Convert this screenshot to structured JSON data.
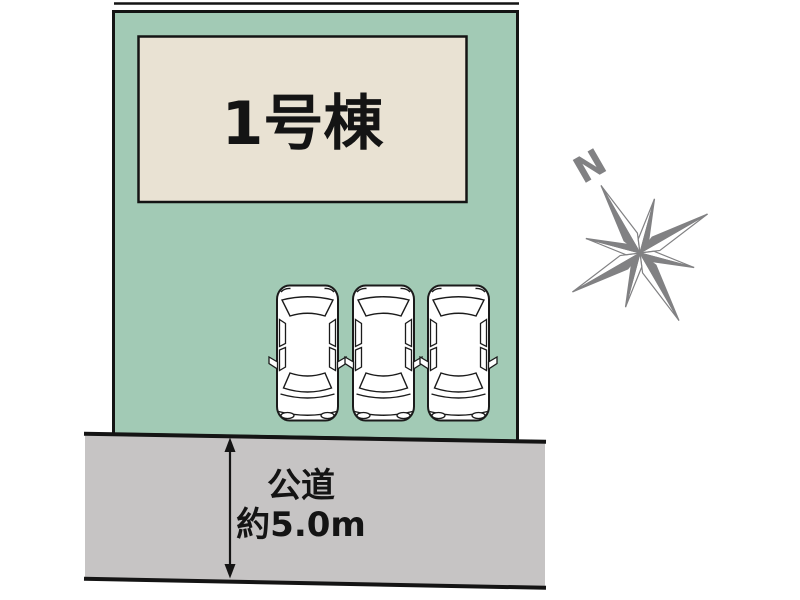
{
  "plot": {
    "building_label": "1号棟"
  },
  "road": {
    "label_line1": "公道",
    "label_line2": "約5.0m"
  },
  "compass": {
    "north_label": "N"
  },
  "cars": {
    "count": 3
  },
  "colors": {
    "plot_green": "#a2cab5",
    "building_beige": "#e9e2d3",
    "road_gray": "#c6c4c4",
    "compass_gray": "#818183",
    "line_black": "#141414"
  }
}
